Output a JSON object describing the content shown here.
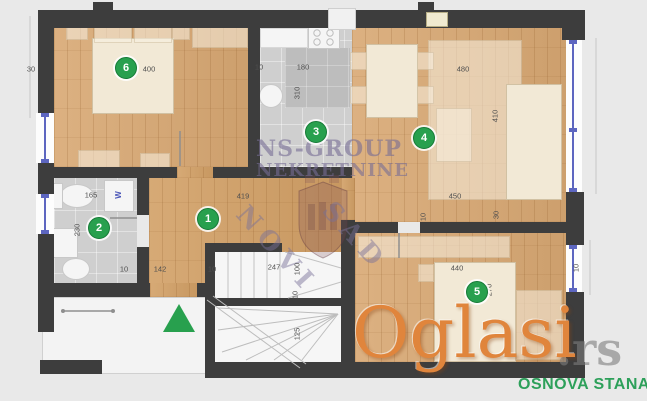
{
  "watermarks": {
    "agency_name": "NS-GROUP",
    "agency_type": "NEKRETNINE",
    "agency_city_word1": "NOVI",
    "agency_city_word2": "SAD",
    "portal_name": "Oglasi",
    "portal_domain": ".rs",
    "caption": "OSNOVA STANA"
  },
  "badges": [
    "1",
    "2",
    "3",
    "4",
    "5",
    "6"
  ],
  "dims": [
    "30",
    "400",
    "10",
    "180",
    "310",
    "480",
    "410",
    "419",
    "165",
    "230",
    "10",
    "142",
    "10",
    "247",
    "100",
    "10",
    "125",
    "450",
    "10",
    "30",
    "440",
    "270",
    "10"
  ],
  "labels": {
    "washing_machine": "W"
  },
  "colors": {
    "badge_green": "#28a04e",
    "entrance_green": "#28a04e",
    "caption_green": "#2da05a",
    "portal_orange": "#e0853c",
    "agency_purple": "#766c94",
    "window_blue": "#5d66c0",
    "wall_dark": "#3d3d3d",
    "wood_floor": "#d8a873",
    "tile_gray": "#cfcfcf",
    "background": "#e9e9e9"
  }
}
